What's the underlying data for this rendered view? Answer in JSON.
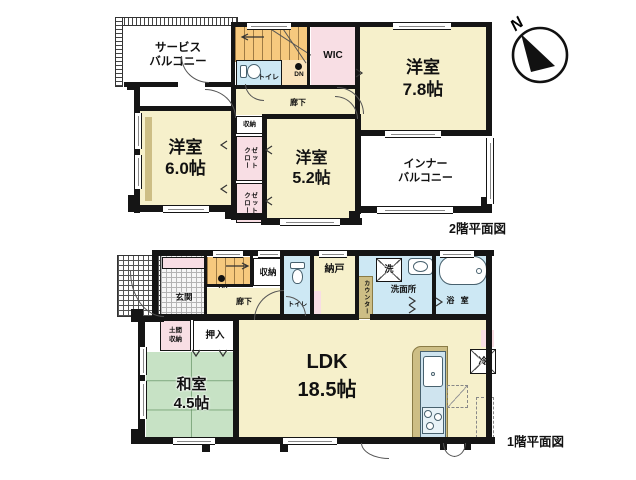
{
  "compass": {
    "north_label": "N"
  },
  "floor2": {
    "caption": "2階平面図",
    "rooms": {
      "service_balcony": "サービス\nバルコニー",
      "wic": "WIC",
      "bedroom_7_8": "洋室\n7.8帖",
      "bedroom_6_0": "洋室\n6.0帖",
      "bedroom_5_2": "洋室\n5.2帖",
      "inner_balcony": "インナー\nバルコニー",
      "hallway": "廊下",
      "toilet": "トイレ",
      "storage": "収納",
      "closet_upper": "クロー\nゼット",
      "closet_lower": "クロー\nゼット",
      "stairs_down": "DN"
    }
  },
  "floor1": {
    "caption": "1階平面図",
    "rooms": {
      "entrance": "玄関",
      "entrance_dirt_storage": "土間\n収納",
      "oshiire": "押入",
      "washitsu": "和室\n4.5帖",
      "ldk": "LDK\n18.5帖",
      "nando": "納戸",
      "toilet": "トイレ",
      "laundry": "洗",
      "washroom": "洗面所",
      "bathroom": "浴 室",
      "counter": "カウンター",
      "fridge": "冷",
      "hallway": "廊下",
      "storage": "収納",
      "stairs_up": "UP"
    }
  }
}
